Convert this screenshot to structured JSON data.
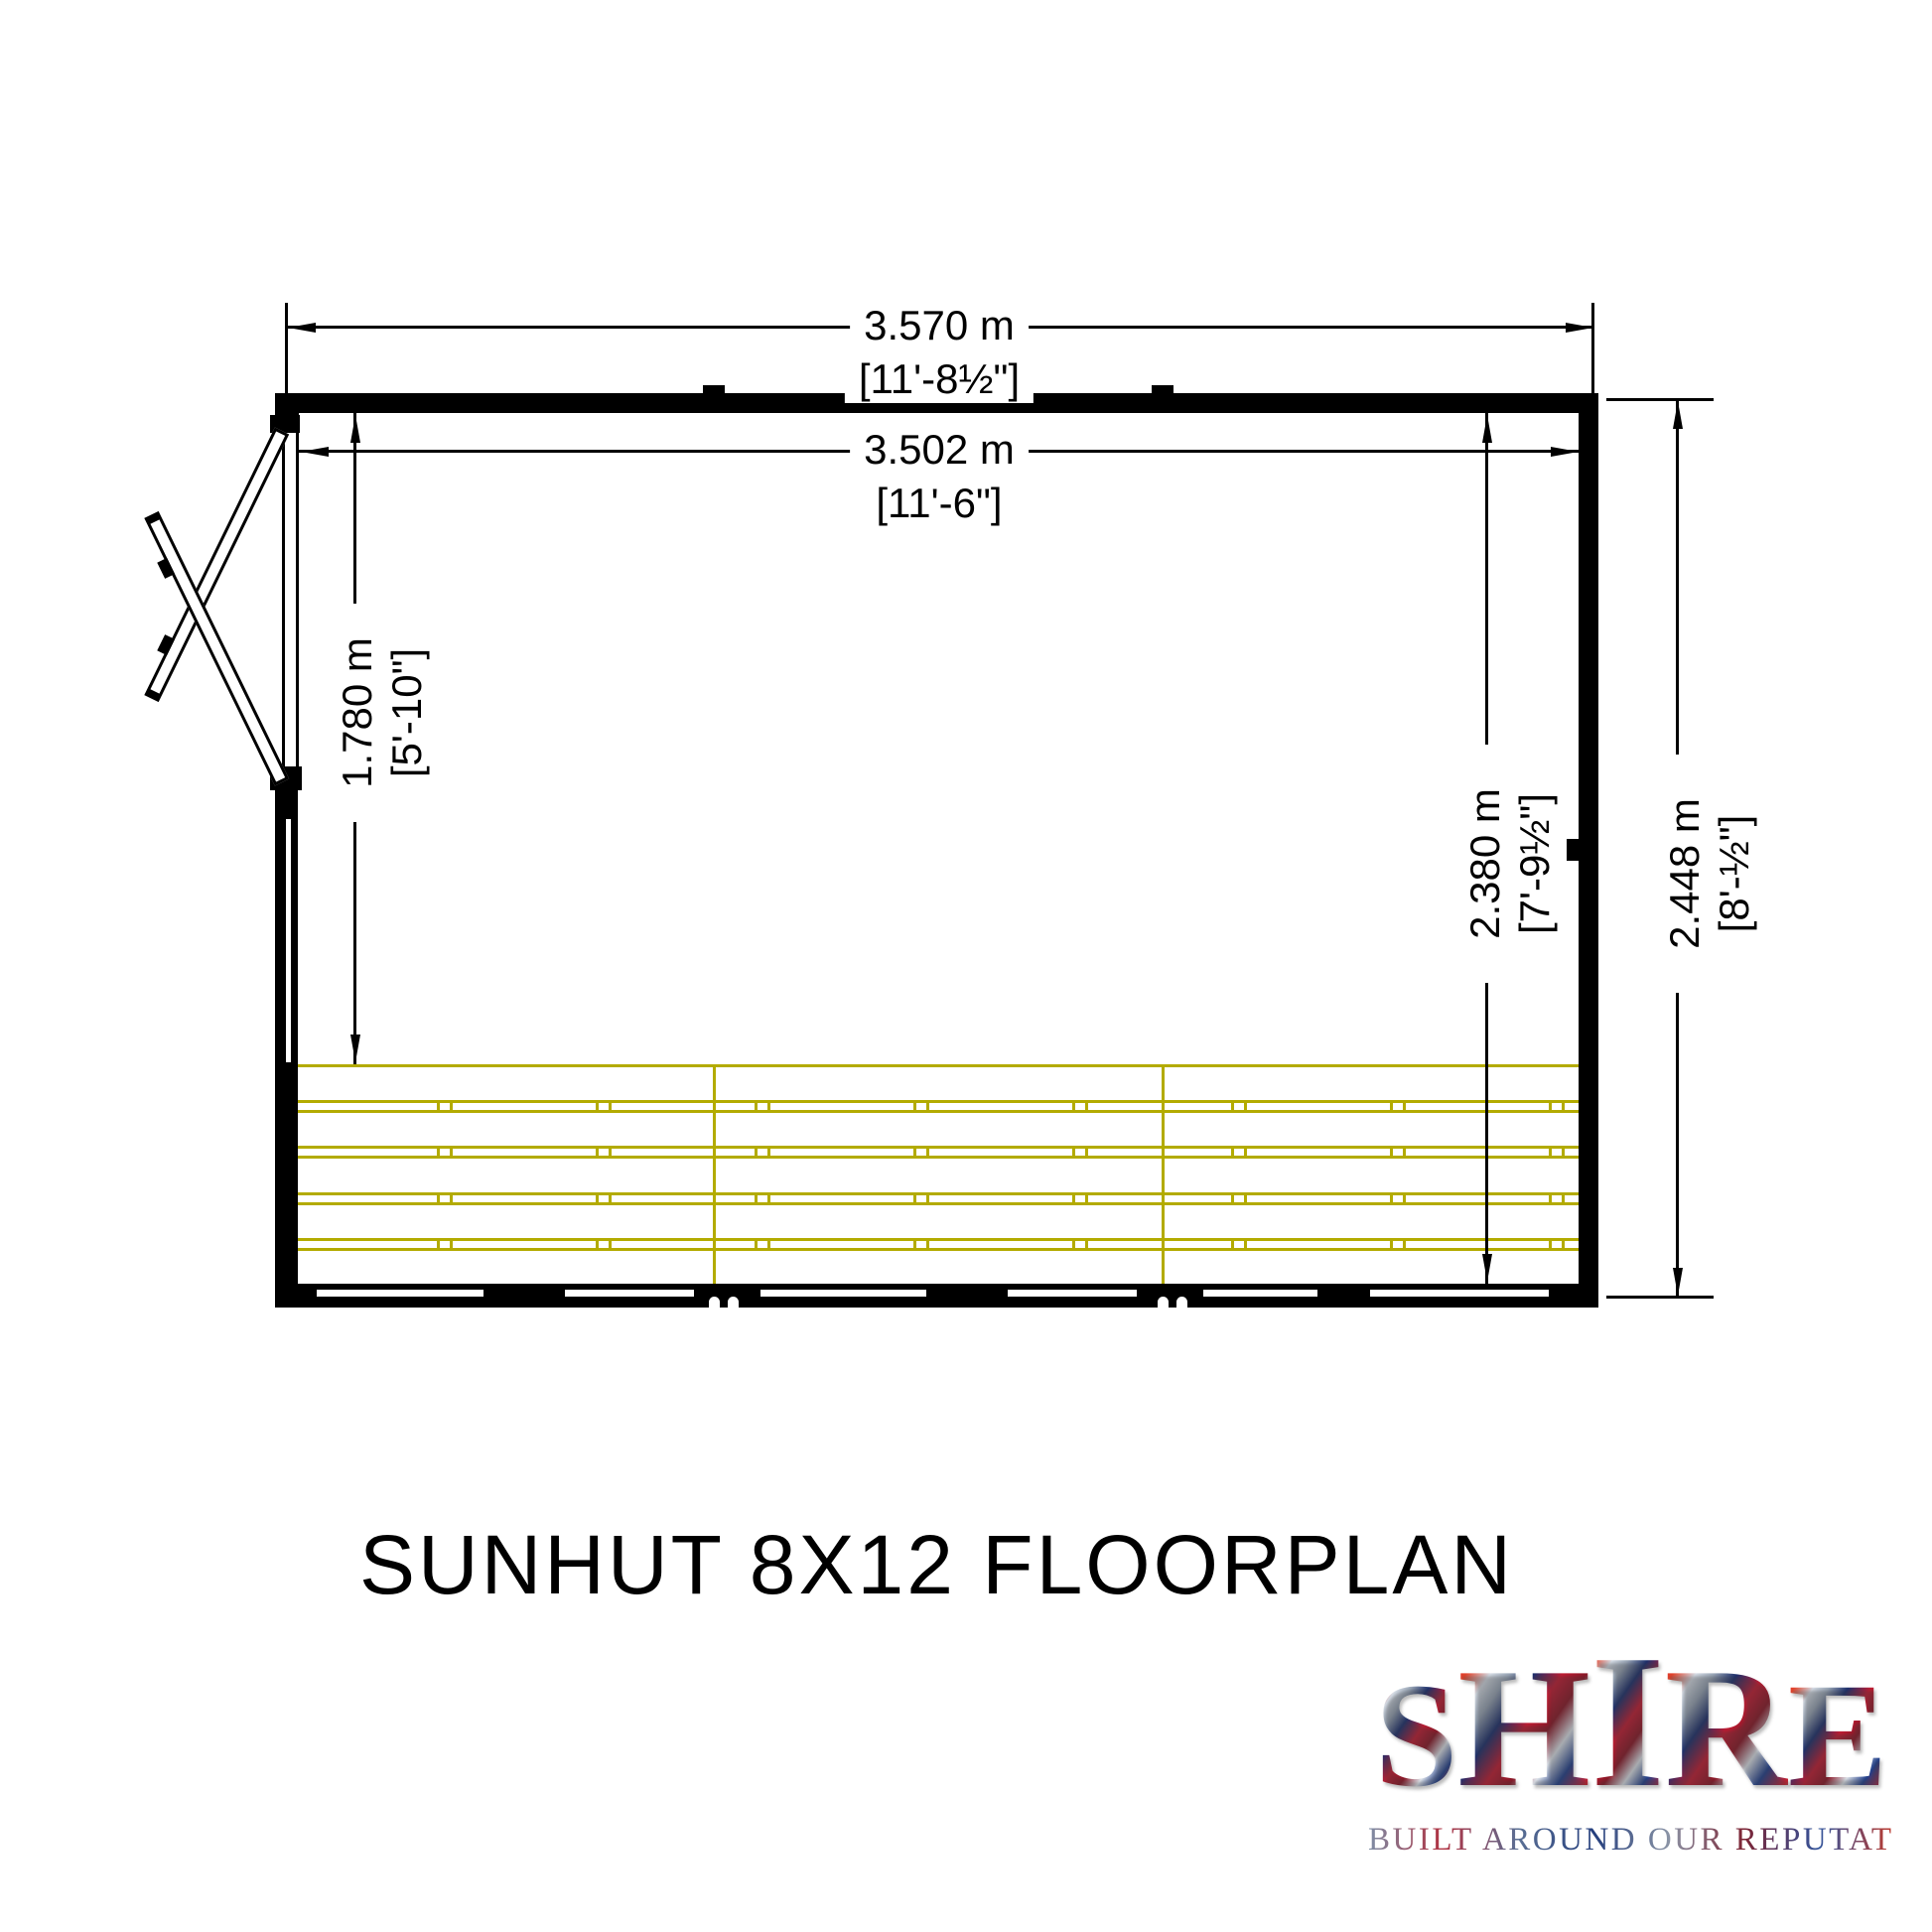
{
  "title": "SUNHUT 8X12 FLOORPLAN",
  "dimensions": {
    "overall_width": {
      "metric": "3.570 m",
      "imperial": "[11'-8½\"]"
    },
    "internal_width": {
      "metric": "3.502 m",
      "imperial": "[11'-6\"]"
    },
    "door_opening": {
      "metric": "1.780 m",
      "imperial": "[5'-10\"]"
    },
    "internal_depth": {
      "metric": "2.380 m",
      "imperial": "[7'-9½\"]"
    },
    "overall_depth": {
      "metric": "2.448 m",
      "imperial": "[8'-½\"]"
    }
  },
  "colors": {
    "wall": "#000000",
    "staging": "#b3ab00",
    "dimension_line": "#000000"
  },
  "logo": {
    "brand": "SHIRE",
    "letters": [
      "S",
      "H",
      "I",
      "R",
      "E"
    ],
    "tagline": "BUILT AROUND OUR REPUTATION",
    "flag_red": "#c8102e",
    "flag_blue": "#012169"
  }
}
